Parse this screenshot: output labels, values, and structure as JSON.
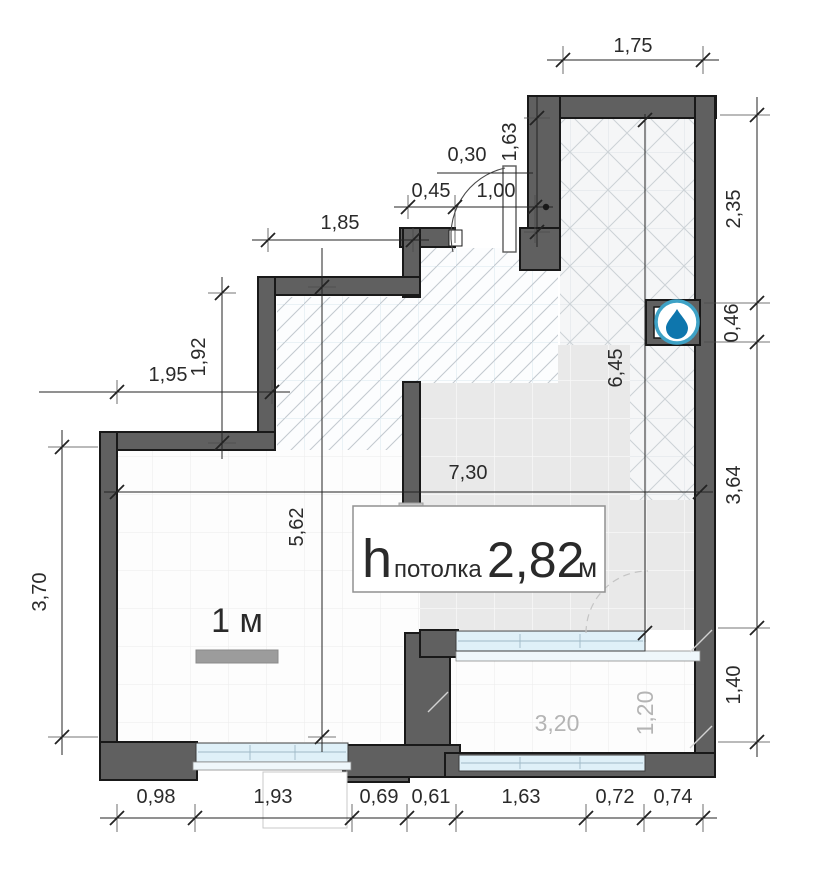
{
  "plan": {
    "ceiling": {
      "symbol": "h",
      "label": "потолка",
      "value": "2,82",
      "unit": "м"
    },
    "scale": {
      "label": "1 м"
    },
    "balcony": {
      "width": "3,20",
      "depth": "1,20"
    },
    "icons": {
      "niche": "water-drop-icon"
    },
    "colors": {
      "wall": "#606060",
      "window": "#dff0f8",
      "drop": "#0e76ad",
      "drop_ring": "#3ea2c6",
      "dim_text": "#2a2a2a",
      "balcony_text": "#b4b4b4"
    },
    "dims": {
      "top_width": "1,75",
      "hall_left_height": "1,63",
      "door_offset": "0,30",
      "door_left": "0,45",
      "door_width": "1,00",
      "upper_wall": "1,85",
      "right_upper": "2,35",
      "right_niche": "0,46",
      "right_mid": "3,64",
      "right_lower": "1,40",
      "left_step_w": "1,95",
      "left_step_h": "1,92",
      "left_height": "3,70",
      "room_height": "5,62",
      "room_width": "7,30",
      "hall_height": "6,45",
      "bottom": [
        "0,98",
        "1,93",
        "0,69",
        "0,61",
        "1,63",
        "0,72",
        "0,74"
      ]
    }
  }
}
